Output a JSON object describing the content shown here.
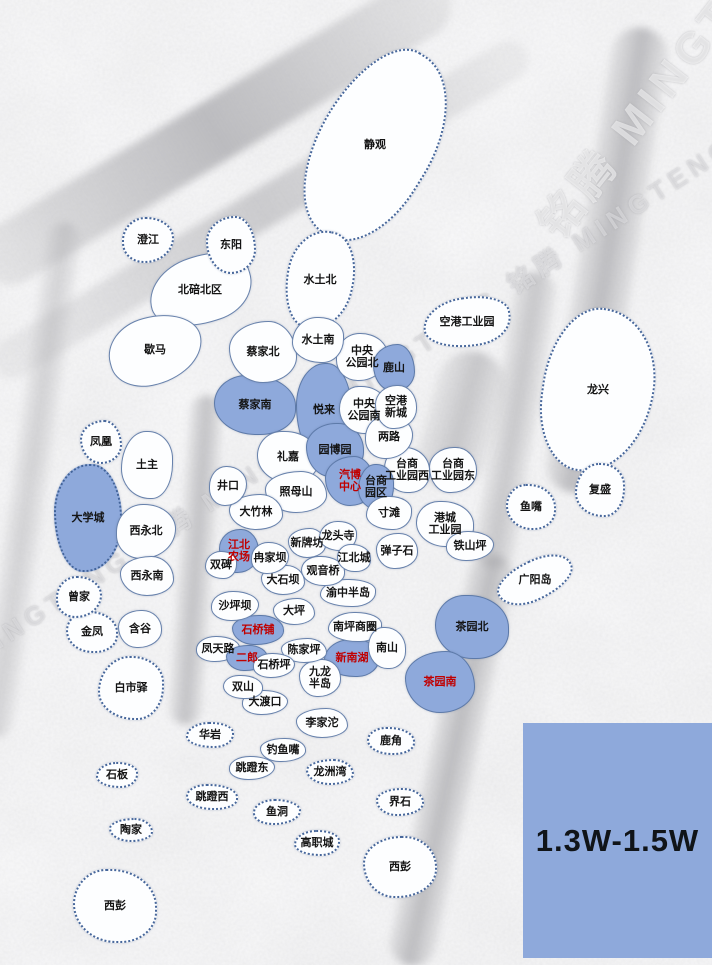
{
  "map_meta": {
    "watermark_text": "铭腾 MINGTENG",
    "watermark_diag_text": "MINGTENG 铭腾 MINGTENG"
  },
  "legend": {
    "label": "1.3W-1.5W",
    "fill": "#8EA9DB",
    "text_color": "#101418",
    "x": 523,
    "y": 723,
    "w": 189,
    "h": 235
  },
  "palette": {
    "region_fill": "#FDFEFF",
    "highlight_fill": "#8EA9DB",
    "border": "#5874A3",
    "label": "#141414",
    "label_red": "#C00000",
    "background": "#ECECEC"
  },
  "regions": [
    {
      "label": "澄江",
      "x": 148,
      "y": 240,
      "w": 52,
      "h": 46,
      "hl": 0,
      "red": 0,
      "dot": 1,
      "rot": 0
    },
    {
      "label": "东阳",
      "x": 231,
      "y": 245,
      "w": 50,
      "h": 58,
      "hl": 0,
      "red": 0,
      "dot": 1,
      "rot": 0
    },
    {
      "label": "北碚北区",
      "x": 200,
      "y": 290,
      "w": 105,
      "h": 68,
      "hl": 0,
      "red": 0,
      "dot": 0,
      "rot": -18
    },
    {
      "label": "静观",
      "x": 375,
      "y": 145,
      "w": 115,
      "h": 205,
      "hl": 0,
      "red": 0,
      "dot": 1,
      "rot": 32
    },
    {
      "label": "水土北",
      "x": 320,
      "y": 280,
      "w": 68,
      "h": 100,
      "hl": 0,
      "red": 0,
      "dot": 1,
      "rot": 12
    },
    {
      "label": "歇马",
      "x": 155,
      "y": 350,
      "w": 95,
      "h": 68,
      "hl": 0,
      "red": 0,
      "dot": 0,
      "rot": -15
    },
    {
      "label": "蔡家北",
      "x": 263,
      "y": 352,
      "w": 68,
      "h": 62,
      "hl": 0,
      "red": 0,
      "dot": 0,
      "rot": 0
    },
    {
      "label": "水土南",
      "x": 318,
      "y": 340,
      "w": 52,
      "h": 46,
      "hl": 0,
      "red": 0,
      "dot": 0,
      "rot": 0
    },
    {
      "label": "蔡家南",
      "x": 255,
      "y": 405,
      "w": 82,
      "h": 60,
      "hl": 1,
      "red": 0,
      "dot": 0,
      "rot": 0
    },
    {
      "label": "悦来",
      "x": 324,
      "y": 410,
      "w": 56,
      "h": 95,
      "hl": 1,
      "red": 0,
      "dot": 0,
      "rot": 0
    },
    {
      "label": "中央\n公园北",
      "x": 362,
      "y": 357,
      "w": 52,
      "h": 48,
      "hl": 0,
      "red": 0,
      "dot": 0,
      "rot": 0
    },
    {
      "label": "鹿山",
      "x": 394,
      "y": 368,
      "w": 42,
      "h": 48,
      "hl": 1,
      "red": 0,
      "dot": 0,
      "rot": 0
    },
    {
      "label": "空港工业园",
      "x": 467,
      "y": 322,
      "w": 88,
      "h": 50,
      "hl": 0,
      "red": 0,
      "dot": 1,
      "rot": -8
    },
    {
      "label": "中央\n公园南",
      "x": 364,
      "y": 410,
      "w": 50,
      "h": 48,
      "hl": 0,
      "red": 0,
      "dot": 0,
      "rot": 0
    },
    {
      "label": "空港\n新城",
      "x": 396,
      "y": 407,
      "w": 42,
      "h": 44,
      "hl": 0,
      "red": 0,
      "dot": 0,
      "rot": 0
    },
    {
      "label": "龙兴",
      "x": 598,
      "y": 390,
      "w": 112,
      "h": 165,
      "hl": 0,
      "red": 0,
      "dot": 1,
      "rot": 8
    },
    {
      "label": "凤凰",
      "x": 101,
      "y": 442,
      "w": 42,
      "h": 44,
      "hl": 0,
      "red": 0,
      "dot": 1,
      "rot": 0
    },
    {
      "label": "土主",
      "x": 147,
      "y": 465,
      "w": 52,
      "h": 68,
      "hl": 0,
      "red": 0,
      "dot": 0,
      "rot": 0
    },
    {
      "label": "礼嘉",
      "x": 288,
      "y": 457,
      "w": 62,
      "h": 52,
      "hl": 0,
      "red": 0,
      "dot": 0,
      "rot": 0
    },
    {
      "label": "园博园",
      "x": 335,
      "y": 450,
      "w": 58,
      "h": 54,
      "hl": 1,
      "red": 0,
      "dot": 0,
      "rot": 0
    },
    {
      "label": "两路",
      "x": 389,
      "y": 437,
      "w": 48,
      "h": 44,
      "hl": 0,
      "red": 0,
      "dot": 0,
      "rot": 0
    },
    {
      "label": "汽博\n中心",
      "x": 350,
      "y": 481,
      "w": 50,
      "h": 50,
      "hl": 1,
      "red": 1,
      "dot": 0,
      "rot": 0
    },
    {
      "label": "台商\n园区",
      "x": 376,
      "y": 487,
      "w": 36,
      "h": 46,
      "hl": 1,
      "red": 0,
      "dot": 0,
      "rot": 0
    },
    {
      "label": "台商\n工业园西",
      "x": 407,
      "y": 470,
      "w": 46,
      "h": 46,
      "hl": 0,
      "red": 0,
      "dot": 0,
      "rot": 0
    },
    {
      "label": "台商\n工业园东",
      "x": 453,
      "y": 470,
      "w": 48,
      "h": 46,
      "hl": 0,
      "red": 0,
      "dot": 0,
      "rot": 0
    },
    {
      "label": "井口",
      "x": 228,
      "y": 486,
      "w": 38,
      "h": 40,
      "hl": 0,
      "red": 0,
      "dot": 0,
      "rot": 0
    },
    {
      "label": "照母山",
      "x": 296,
      "y": 492,
      "w": 62,
      "h": 42,
      "hl": 0,
      "red": 0,
      "dot": 0,
      "rot": 0
    },
    {
      "label": "复盛",
      "x": 600,
      "y": 490,
      "w": 50,
      "h": 54,
      "hl": 0,
      "red": 0,
      "dot": 1,
      "rot": 0
    },
    {
      "label": "鱼嘴",
      "x": 531,
      "y": 507,
      "w": 50,
      "h": 46,
      "hl": 0,
      "red": 0,
      "dot": 1,
      "rot": 0
    },
    {
      "label": "大学城",
      "x": 88,
      "y": 518,
      "w": 68,
      "h": 108,
      "hl": 1,
      "red": 0,
      "dot": 1,
      "rot": 0
    },
    {
      "label": "西永北",
      "x": 146,
      "y": 531,
      "w": 60,
      "h": 55,
      "hl": 0,
      "red": 0,
      "dot": 0,
      "rot": 0
    },
    {
      "label": "大竹林",
      "x": 256,
      "y": 512,
      "w": 54,
      "h": 36,
      "hl": 0,
      "red": 0,
      "dot": 0,
      "rot": 0
    },
    {
      "label": "寸滩",
      "x": 389,
      "y": 513,
      "w": 46,
      "h": 34,
      "hl": 0,
      "red": 0,
      "dot": 0,
      "rot": 0
    },
    {
      "label": "港城\n工业园",
      "x": 445,
      "y": 524,
      "w": 58,
      "h": 46,
      "hl": 0,
      "red": 0,
      "dot": 0,
      "rot": 0
    },
    {
      "label": "江北\n农场",
      "x": 239,
      "y": 551,
      "w": 40,
      "h": 44,
      "hl": 1,
      "red": 1,
      "dot": 0,
      "rot": 0
    },
    {
      "label": "冉家坝",
      "x": 270,
      "y": 558,
      "w": 38,
      "h": 32,
      "hl": 0,
      "red": 0,
      "dot": 0,
      "rot": 0
    },
    {
      "label": "新牌坊",
      "x": 307,
      "y": 543,
      "w": 38,
      "h": 30,
      "hl": 0,
      "red": 0,
      "dot": 0,
      "rot": 0
    },
    {
      "label": "龙头寺",
      "x": 338,
      "y": 536,
      "w": 38,
      "h": 30,
      "hl": 0,
      "red": 0,
      "dot": 0,
      "rot": 0
    },
    {
      "label": "江北城",
      "x": 354,
      "y": 558,
      "w": 34,
      "h": 28,
      "hl": 0,
      "red": 0,
      "dot": 0,
      "rot": 0
    },
    {
      "label": "弹子石",
      "x": 397,
      "y": 551,
      "w": 42,
      "h": 36,
      "hl": 0,
      "red": 0,
      "dot": 0,
      "rot": 0
    },
    {
      "label": "铁山坪",
      "x": 470,
      "y": 546,
      "w": 48,
      "h": 30,
      "hl": 0,
      "red": 0,
      "dot": 0,
      "rot": 0
    },
    {
      "label": "西永南",
      "x": 147,
      "y": 576,
      "w": 54,
      "h": 40,
      "hl": 0,
      "red": 0,
      "dot": 0,
      "rot": 0
    },
    {
      "label": "双碑",
      "x": 221,
      "y": 565,
      "w": 32,
      "h": 28,
      "hl": 0,
      "red": 0,
      "dot": 0,
      "rot": 0
    },
    {
      "label": "观音桥",
      "x": 323,
      "y": 571,
      "w": 44,
      "h": 30,
      "hl": 0,
      "red": 0,
      "dot": 0,
      "rot": 0
    },
    {
      "label": "广阳岛",
      "x": 535,
      "y": 580,
      "w": 80,
      "h": 40,
      "hl": 0,
      "red": 0,
      "dot": 1,
      "rot": -25
    },
    {
      "label": "曾家",
      "x": 79,
      "y": 597,
      "w": 46,
      "h": 42,
      "hl": 0,
      "red": 0,
      "dot": 1,
      "rot": 0
    },
    {
      "label": "大石坝",
      "x": 283,
      "y": 580,
      "w": 44,
      "h": 30,
      "hl": 0,
      "red": 0,
      "dot": 0,
      "rot": 0
    },
    {
      "label": "渝中半岛",
      "x": 348,
      "y": 593,
      "w": 56,
      "h": 28,
      "hl": 0,
      "red": 0,
      "dot": 0,
      "rot": 0
    },
    {
      "label": "金凤",
      "x": 92,
      "y": 632,
      "w": 52,
      "h": 42,
      "hl": 0,
      "red": 0,
      "dot": 1,
      "rot": 0
    },
    {
      "label": "含谷",
      "x": 140,
      "y": 629,
      "w": 44,
      "h": 38,
      "hl": 0,
      "red": 0,
      "dot": 0,
      "rot": 0
    },
    {
      "label": "沙坪坝",
      "x": 235,
      "y": 606,
      "w": 48,
      "h": 30,
      "hl": 0,
      "red": 0,
      "dot": 0,
      "rot": 0
    },
    {
      "label": "大坪",
      "x": 294,
      "y": 611,
      "w": 42,
      "h": 27,
      "hl": 0,
      "red": 0,
      "dot": 0,
      "rot": 0
    },
    {
      "label": "南坪商圈",
      "x": 355,
      "y": 627,
      "w": 54,
      "h": 30,
      "hl": 0,
      "red": 0,
      "dot": 0,
      "rot": 0
    },
    {
      "label": "茶园北",
      "x": 472,
      "y": 627,
      "w": 74,
      "h": 64,
      "hl": 1,
      "red": 0,
      "dot": 0,
      "rot": 0
    },
    {
      "label": "石桥铺",
      "x": 258,
      "y": 630,
      "w": 52,
      "h": 30,
      "hl": 1,
      "red": 1,
      "dot": 0,
      "rot": 0
    },
    {
      "label": "凤天路",
      "x": 218,
      "y": 649,
      "w": 44,
      "h": 26,
      "hl": 0,
      "red": 0,
      "dot": 0,
      "rot": 0
    },
    {
      "label": "陈家坪",
      "x": 304,
      "y": 650,
      "w": 46,
      "h": 25,
      "hl": 0,
      "red": 0,
      "dot": 0,
      "rot": 0
    },
    {
      "label": "新南湖",
      "x": 352,
      "y": 658,
      "w": 56,
      "h": 38,
      "hl": 1,
      "red": 1,
      "dot": 0,
      "rot": 0
    },
    {
      "label": "南山",
      "x": 387,
      "y": 648,
      "w": 38,
      "h": 42,
      "hl": 0,
      "red": 0,
      "dot": 0,
      "rot": 0
    },
    {
      "label": "二郎",
      "x": 247,
      "y": 658,
      "w": 42,
      "h": 26,
      "hl": 1,
      "red": 1,
      "dot": 0,
      "rot": 0
    },
    {
      "label": "石桥坪",
      "x": 274,
      "y": 665,
      "w": 42,
      "h": 25,
      "hl": 0,
      "red": 0,
      "dot": 0,
      "rot": 0
    },
    {
      "label": "茶园南",
      "x": 440,
      "y": 682,
      "w": 70,
      "h": 62,
      "hl": 1,
      "red": 1,
      "dot": 0,
      "rot": 0
    },
    {
      "label": "白市驿",
      "x": 131,
      "y": 688,
      "w": 66,
      "h": 64,
      "hl": 0,
      "red": 0,
      "dot": 1,
      "rot": 0
    },
    {
      "label": "双山",
      "x": 243,
      "y": 687,
      "w": 40,
      "h": 24,
      "hl": 0,
      "red": 0,
      "dot": 0,
      "rot": 0
    },
    {
      "label": "九龙\n半岛",
      "x": 320,
      "y": 678,
      "w": 42,
      "h": 38,
      "hl": 0,
      "red": 0,
      "dot": 0,
      "rot": 0
    },
    {
      "label": "大渡口",
      "x": 265,
      "y": 702,
      "w": 46,
      "h": 25,
      "hl": 0,
      "red": 0,
      "dot": 0,
      "rot": 0
    },
    {
      "label": "李家沱",
      "x": 322,
      "y": 723,
      "w": 52,
      "h": 30,
      "hl": 0,
      "red": 0,
      "dot": 0,
      "rot": 0
    },
    {
      "label": "华岩",
      "x": 210,
      "y": 735,
      "w": 48,
      "h": 26,
      "hl": 0,
      "red": 0,
      "dot": 1,
      "rot": 0
    },
    {
      "label": "鹿角",
      "x": 391,
      "y": 741,
      "w": 48,
      "h": 28,
      "hl": 0,
      "red": 0,
      "dot": 1,
      "rot": 0
    },
    {
      "label": "钓鱼嘴",
      "x": 283,
      "y": 750,
      "w": 46,
      "h": 24,
      "hl": 0,
      "red": 0,
      "dot": 0,
      "rot": 0
    },
    {
      "label": "跳蹬东",
      "x": 252,
      "y": 768,
      "w": 46,
      "h": 24,
      "hl": 0,
      "red": 0,
      "dot": 0,
      "rot": 0
    },
    {
      "label": "龙洲湾",
      "x": 330,
      "y": 772,
      "w": 48,
      "h": 26,
      "hl": 0,
      "red": 0,
      "dot": 1,
      "rot": 0
    },
    {
      "label": "石板",
      "x": 117,
      "y": 775,
      "w": 42,
      "h": 26,
      "hl": 0,
      "red": 0,
      "dot": 1,
      "rot": 0
    },
    {
      "label": "跳蹬西",
      "x": 212,
      "y": 797,
      "w": 52,
      "h": 26,
      "hl": 0,
      "red": 0,
      "dot": 1,
      "rot": 0
    },
    {
      "label": "界石",
      "x": 400,
      "y": 802,
      "w": 48,
      "h": 28,
      "hl": 0,
      "red": 0,
      "dot": 1,
      "rot": 0
    },
    {
      "label": "鱼洞",
      "x": 277,
      "y": 812,
      "w": 48,
      "h": 26,
      "hl": 0,
      "red": 0,
      "dot": 1,
      "rot": 0
    },
    {
      "label": "陶家",
      "x": 131,
      "y": 830,
      "w": 44,
      "h": 24,
      "hl": 0,
      "red": 0,
      "dot": 1,
      "rot": 0
    },
    {
      "label": "高职城",
      "x": 317,
      "y": 843,
      "w": 46,
      "h": 26,
      "hl": 0,
      "red": 0,
      "dot": 1,
      "rot": 0
    },
    {
      "label": "西彭",
      "x": 115,
      "y": 906,
      "w": 84,
      "h": 74,
      "hl": 0,
      "red": 0,
      "dot": 1,
      "rot": 0
    },
    {
      "label": "西彭",
      "x": 400,
      "y": 867,
      "w": 74,
      "h": 62,
      "hl": 0,
      "red": 0,
      "dot": 1,
      "rot": 0
    }
  ]
}
